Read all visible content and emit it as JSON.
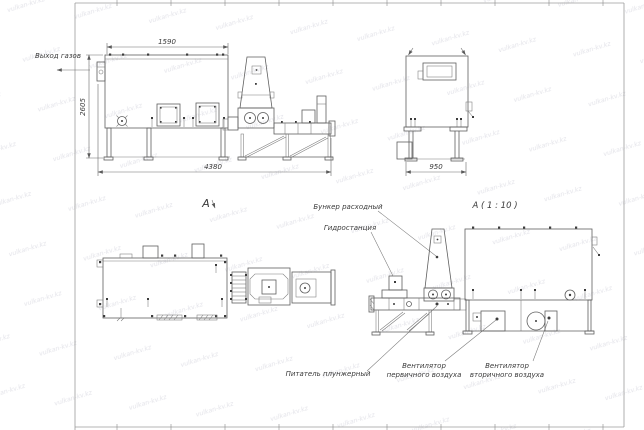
{
  "watermark": {
    "text": "vulkan-kv.kz"
  },
  "colors": {
    "line": "#5f5f5f",
    "dimension": "#6a6a6a",
    "text": "#3a3a3a",
    "watermark": "#e3e3e9",
    "background": "#ffffff"
  },
  "side_view": {
    "view_label": "А",
    "gas_outlet_label": "Выход газов",
    "dim_top": "1590",
    "dim_height": "2605",
    "dim_length": "4380"
  },
  "end_view": {
    "dim_width": "950"
  },
  "detail_view": {
    "title": "А ( 1 : 10 )",
    "callouts": {
      "hopper": "Бункер расходный",
      "hydraulic_station": "Гидростанция",
      "plunger_feeder": "Питатель плунжерный",
      "primary_fan_line1": "Вентилятор",
      "primary_fan_line2": "первичного воздуха",
      "secondary_fan_line1": "Вентилятор",
      "secondary_fan_line2": "вторичного воздуха"
    }
  }
}
